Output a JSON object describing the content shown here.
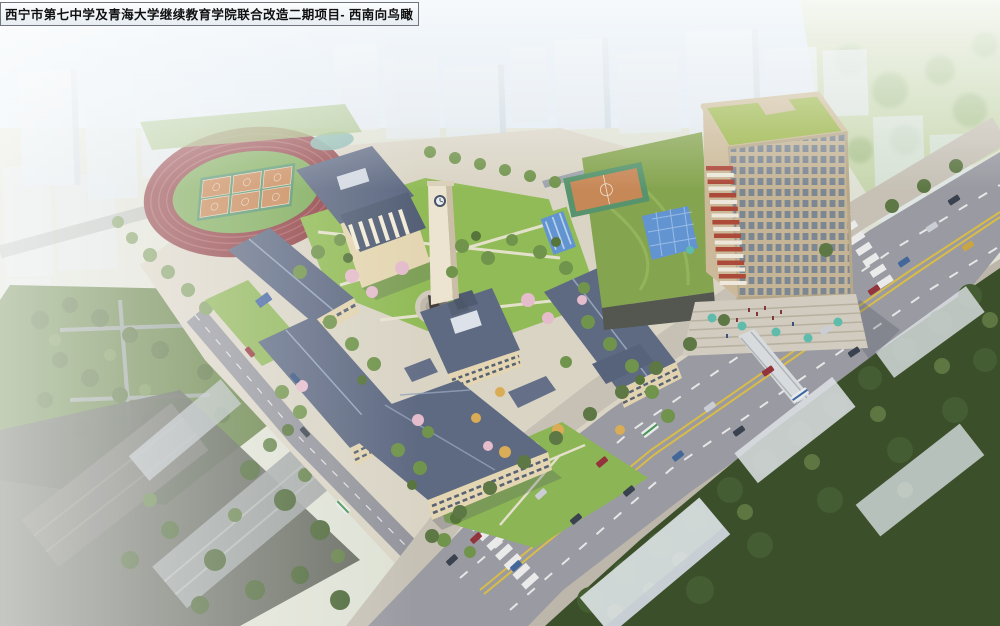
{
  "title_label": {
    "text": "西宁市第七中学及青海大学继续教育学院联合改造二期项目- 西南向鸟瞰"
  },
  "scene": {
    "type": "aerial architectural rendering, bird's-eye view toward southwest",
    "palette": {
      "sky_haze": "#d9e7f1",
      "background_city": "#d8e1e9",
      "track_red": "#8e3c40",
      "field_green": "#79a853",
      "court_orange": "#c5824f",
      "court_green": "#4f8f66",
      "roof_slate": "#56627c",
      "wall_cream": "#e3d4ae",
      "lawn_green": "#8cb84f",
      "tree_green": "#64883f",
      "tree_dark": "#33491f",
      "blossom_pink": "#e3b9c9",
      "road_gray": "#94959d",
      "lane_yellow": "#d7b93f",
      "tower_beige": "#c9b694",
      "tower_roof_green": "#96b23f",
      "accent_red": "#a8402f",
      "glass_blue": "#5b8fd0",
      "pond_teal": "#7fb3a9",
      "umbrella_teal": "#57b8a8"
    }
  }
}
